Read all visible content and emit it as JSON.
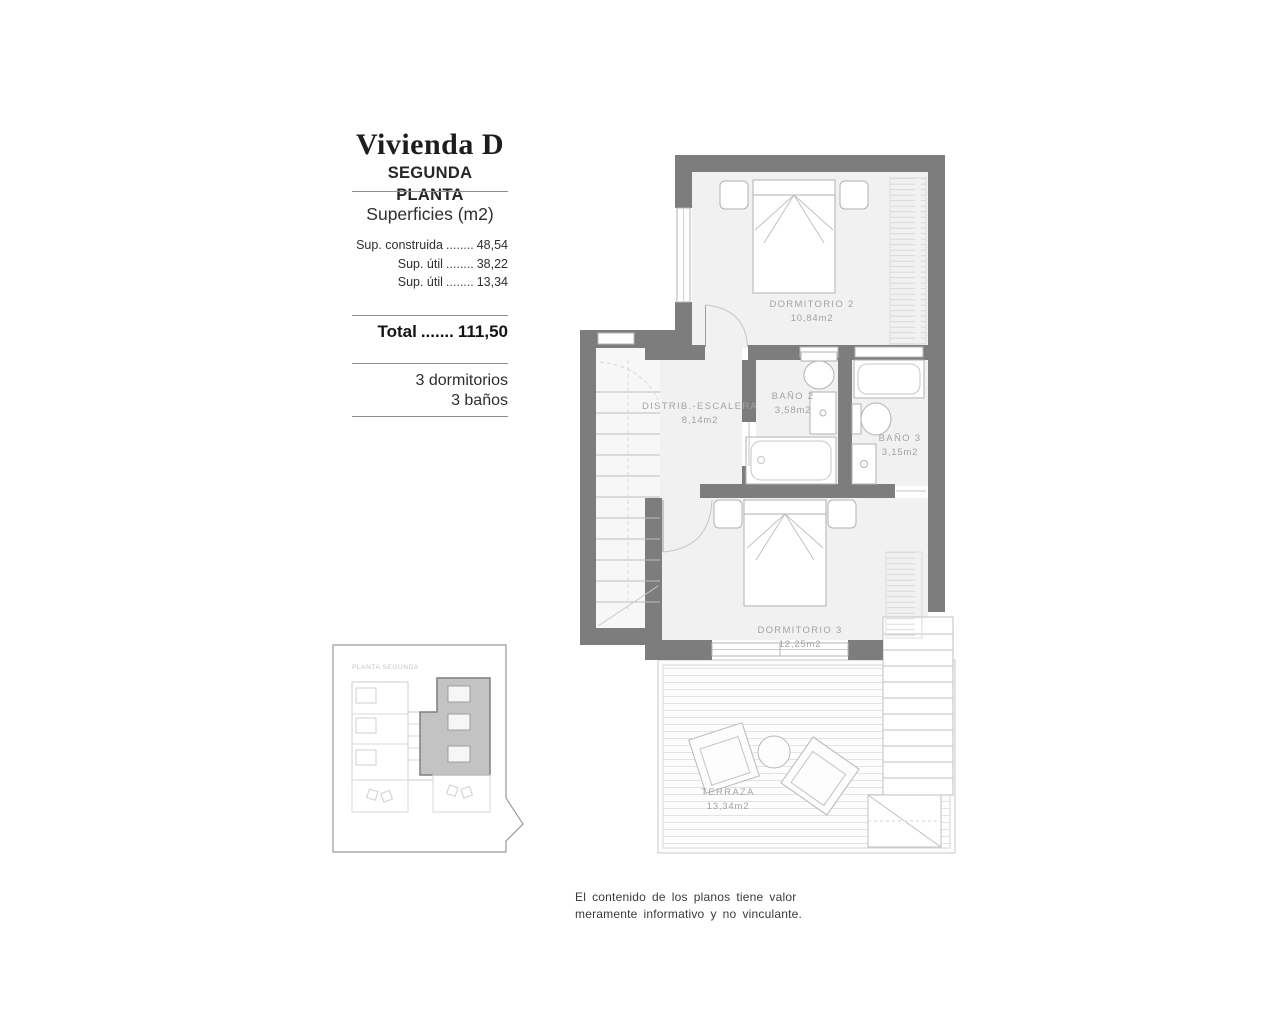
{
  "title_block": {
    "title": "Vivienda D",
    "subtitle": "SEGUNDA PLANTA",
    "surfaces_heading": "Superficies (m2)",
    "surface_rows": [
      {
        "label": "Sup. construida",
        "dots": "........",
        "value": "48,54"
      },
      {
        "label": "Sup. útil",
        "dots": "........",
        "value": "38,22"
      },
      {
        "label": "Sup. útil",
        "dots": "........",
        "value": "13,34"
      }
    ],
    "total": {
      "label": "Total",
      "dots": ".......",
      "value": "111,50"
    },
    "program": {
      "line1": "3 dormitorios",
      "line2": "3 baños"
    }
  },
  "plan": {
    "rooms": [
      {
        "name": "DORMITORIO 2",
        "area": "10,84m2"
      },
      {
        "name": "DISTRIB.-ESCALERA",
        "area": "8,14m2"
      },
      {
        "name": "BAÑO 2",
        "area": "3,58m2"
      },
      {
        "name": "BAÑO 3",
        "area": "3,15m2"
      },
      {
        "name": "DORMITORIO 3",
        "area": "12,25m2"
      },
      {
        "name": "TERRAZA",
        "area": "13,34m2"
      }
    ]
  },
  "key_plan": {
    "label": "PLANTA SEGUNDA"
  },
  "disclaimer": {
    "line1": "El contenido de los planos tiene valor",
    "line2": "meramente informativo y no vinculante."
  },
  "colors": {
    "wall": "#7d7d7d",
    "room_fill": "#f1f1f1",
    "keyplan_highlight": "#c3c3c3",
    "label_text": "#a3a3a3"
  }
}
